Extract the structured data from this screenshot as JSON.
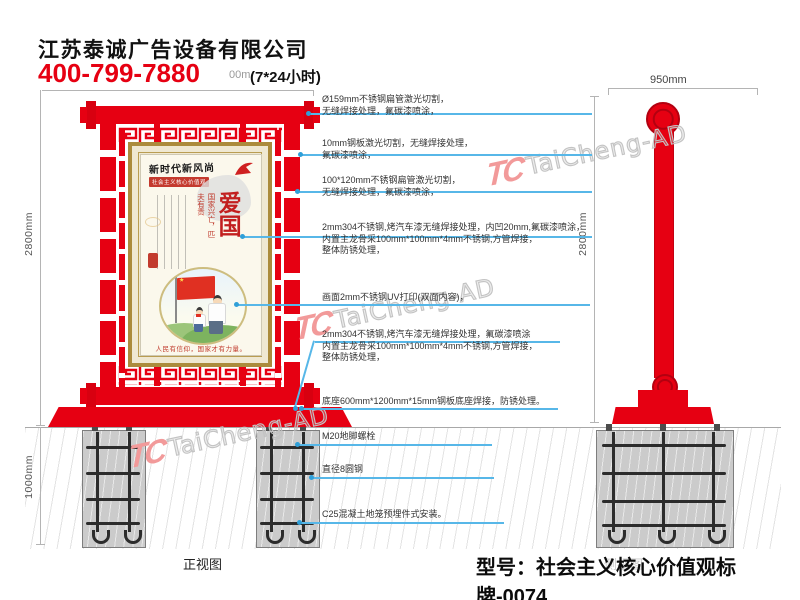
{
  "header": {
    "company": "江苏泰诚广告设备有限公司",
    "phone": "400-799-7880",
    "hours": "(7*24小时)",
    "dim_fragment": "00m"
  },
  "views": {
    "front_label": "正视图",
    "side_label": "侧视图"
  },
  "dims": {
    "front_height": "2800mm",
    "foundation_depth": "1000mm",
    "side_width": "950mm",
    "side_height": "2800mm"
  },
  "poster": {
    "calligraphy": "新时代新风尚",
    "banner": "社会主义核心价值观",
    "main_text": "爱国",
    "side_text": "国家兴亡，匹夫有责",
    "flag_star": "★",
    "bottom_text": "人民有信仰，国家才有力量。"
  },
  "annotations": [
    {
      "text": "Ø159mm不锈钢扁管激光切割，\n无缝焊接处理，氟碳漆喷涂，"
    },
    {
      "text": "10mm钢板激光切割，无缝焊接处理，\n氟碳漆喷涂，"
    },
    {
      "text": "100*120mm不锈钢扁管激光切割，\n无缝焊接处理，氟碳漆喷涂，"
    },
    {
      "text": "2mm304不锈钢,烤汽车漆无缝焊接处理，内凹20mm,氟碳漆喷涂，\n内置主龙骨采100mm*100mm*4mm不锈钢,方管焊接，\n整体防锈处理，"
    },
    {
      "text": "画面2mm不锈钢UV打印(双面内容)，"
    },
    {
      "text": "2mm304不锈钢,烤汽车漆无缝焊接处理，氟碳漆喷涂\n内置主龙骨采100mm*100mm*4mm不锈钢,方管焊接，\n整体防锈处理，"
    },
    {
      "text": "底座600mm*1200mm*15mm钢板底座焊接，防锈处理。"
    },
    {
      "text": "M20地脚螺栓"
    },
    {
      "text": "直径8圆钢"
    },
    {
      "text": "C25混凝土地笼预埋件式安装。"
    }
  ],
  "watermark": {
    "logo": "TC",
    "text": "TaiCheng-AD"
  },
  "footer": {
    "model": "型号：社会主义核心价值观标牌-0074"
  },
  "colors": {
    "sign_red": "#e60012",
    "frame_gold": "#ab8b3c",
    "leader_blue": "#57b7e8",
    "concrete_gray": "#cbcbcb",
    "poster_red": "#c0392b"
  }
}
